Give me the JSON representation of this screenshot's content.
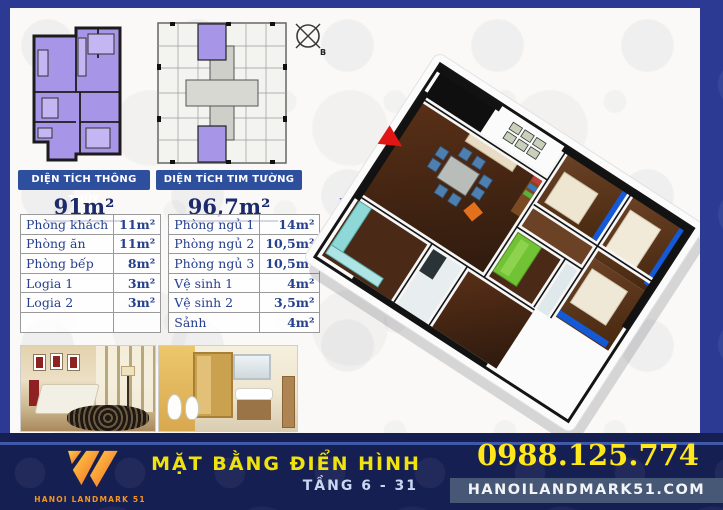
{
  "areas": {
    "left": {
      "title": "DIỆN TÍCH THÔNG THỦY",
      "value": "91m²"
    },
    "right": {
      "title": "DIỆN TÍCH TIM TƯỜNG",
      "value": "96,7m²"
    }
  },
  "room_table": {
    "left_rows": [
      [
        "Phòng khách",
        "11m²"
      ],
      [
        "Phòng ăn",
        "11m²"
      ],
      [
        "Phòng bếp",
        "8m²"
      ],
      [
        "Logia 1",
        "3m²"
      ],
      [
        "Logia 2",
        "3m²"
      ],
      [
        "",
        ""
      ]
    ],
    "right_rows": [
      [
        "Phòng ngủ 1",
        "14m²"
      ],
      [
        "Phòng ngủ 2",
        "10,5m²"
      ],
      [
        "Phòng ngủ 3",
        "10,5m²"
      ],
      [
        "Vệ sinh 1",
        "4m²"
      ],
      [
        "Vệ sinh 2",
        "3,5m²"
      ],
      [
        "Sảnh",
        "4m²"
      ]
    ]
  },
  "compass": {
    "label": "B"
  },
  "footer": {
    "logo_text": "HANOI LANDMARK 51",
    "title": "MẶT BẰNG ĐIỂN HÌNH",
    "subtitle": "TẦNG 6 - 31",
    "phone": "0988.125.774",
    "website": "HANOILANDMARK51.COM"
  },
  "colors": {
    "frame_navy": "#2c3a94",
    "footer_navy": "#161f52",
    "bar_blue": "#2d4f9e",
    "table_text_blue": "#27418f",
    "highlight_purple": "#a795e8",
    "accent_yellow": "#f0e20c",
    "phone_yellow": "#ffe81a",
    "logo_orange": "#f7941d",
    "accent_wall_blue": "#1459d6",
    "wardrobe_green": "#72c236"
  }
}
